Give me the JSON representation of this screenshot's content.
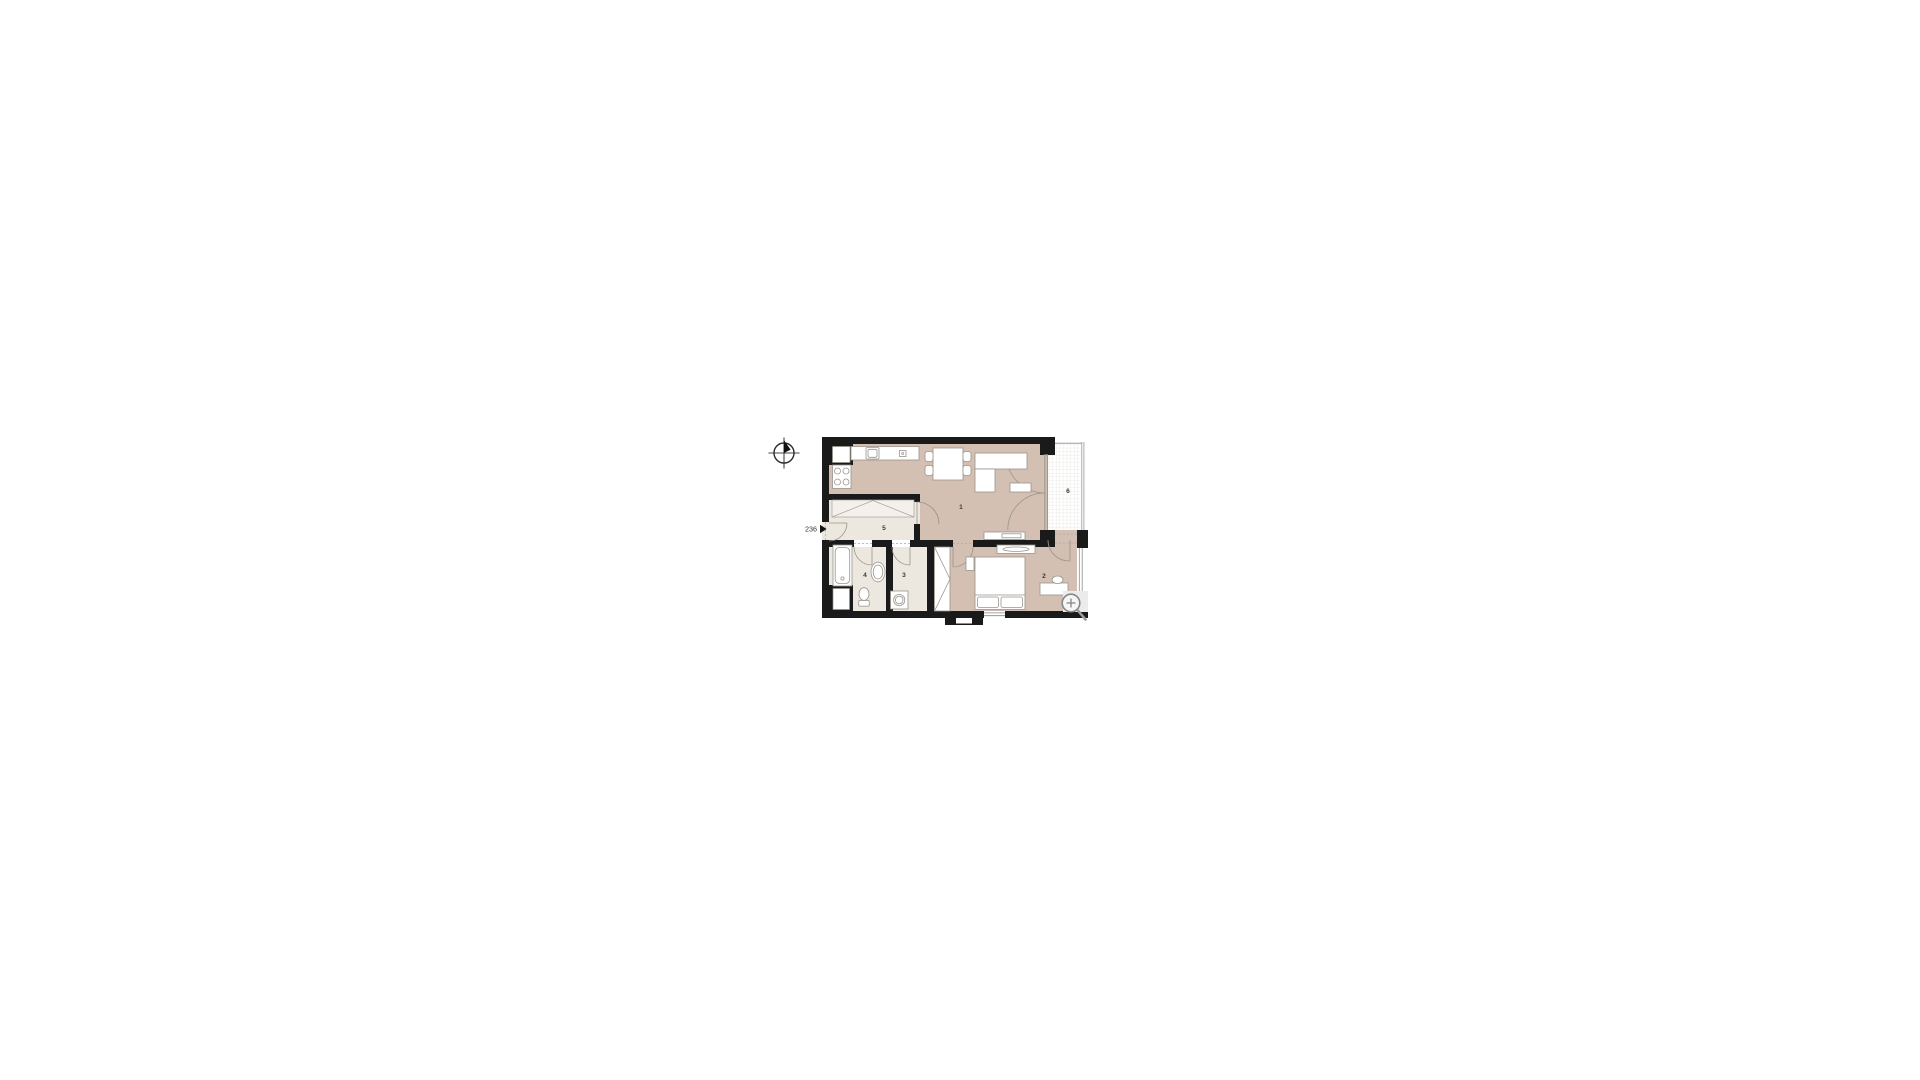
{
  "scene": {
    "background": "#ffffff"
  },
  "entrance": {
    "label": "236"
  },
  "rooms": [
    {
      "label": "1"
    },
    {
      "label": "2"
    },
    {
      "label": "3"
    },
    {
      "label": "4"
    },
    {
      "label": "5"
    },
    {
      "label": "6"
    }
  ],
  "colors": {
    "floor_primary": "#d4c0b2",
    "floor_secondary": "#ece8e0",
    "wall": "#1a1a1a",
    "furniture_outline": "#9a948c",
    "balcony_grid": "#ddd9d2",
    "icon_gray": "#878787"
  },
  "icons": {
    "north_arrow": "north-arrow-icon",
    "entrance_arrow": "entrance-arrow-icon",
    "zoom": "magnifier-icon"
  }
}
